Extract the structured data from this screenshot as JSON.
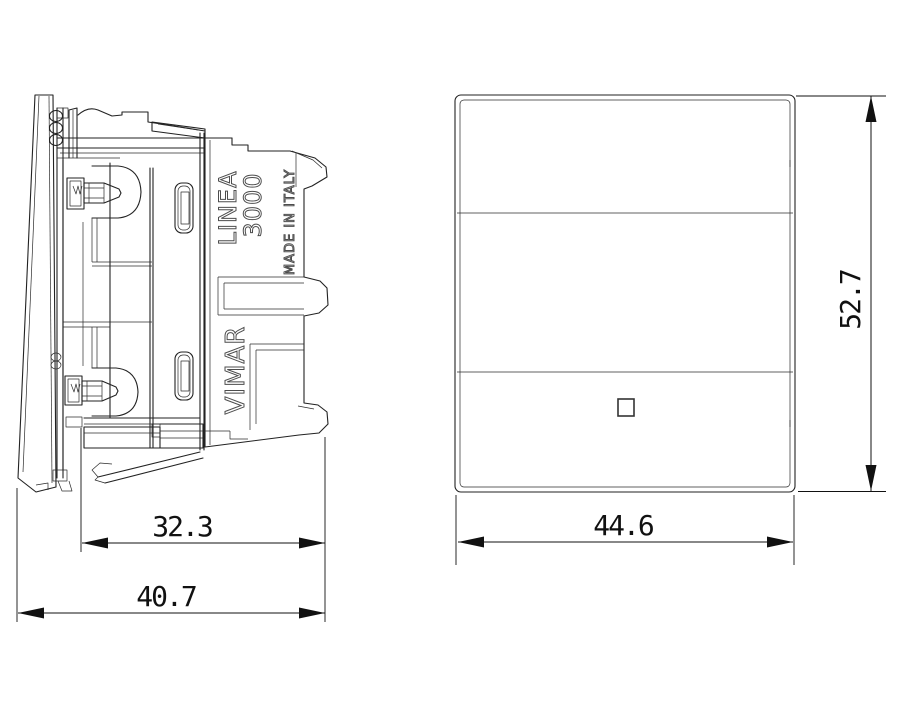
{
  "side_view": {
    "engraved": {
      "series_line1": "LINEA",
      "series_line2": "3000",
      "made_in": "MADE IN ITALY",
      "brand": "VIMAR"
    },
    "dims": {
      "body_depth": "32.3",
      "total_depth": "40.7"
    }
  },
  "front_view": {
    "dims": {
      "width": "44.6",
      "height": "52.7"
    }
  },
  "colors": {
    "line": "#222222",
    "dimension": "#111111",
    "engraved_text": "#4d4d4d",
    "background": "#ffffff"
  }
}
